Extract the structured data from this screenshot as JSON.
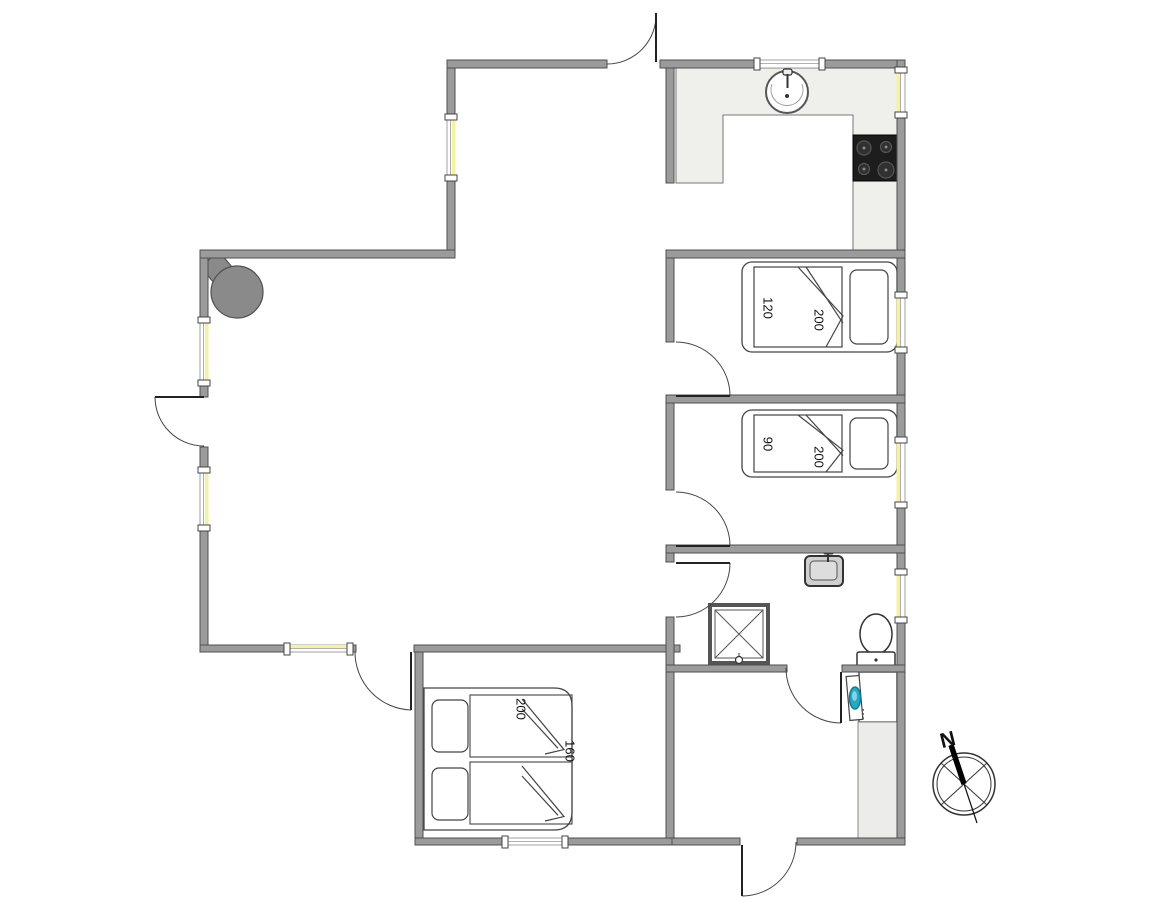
{
  "canvas": {
    "width": 1152,
    "height": 897,
    "background": "#ffffff"
  },
  "colors": {
    "wall": "#9b9b9b",
    "wall_stroke": "#4f4f4f",
    "window_glass": "#f5f2a0",
    "window_frame": "#8a8a8a",
    "counter": "#efefeb",
    "counter_stroke": "#777777",
    "cabinet": "#ececea",
    "stove_body": "#1d1d1d",
    "burner": "#303030",
    "burner_ring": "#555555",
    "fixture_stroke": "#3a3a3a",
    "door_arc": "#444444",
    "wood_stove": "#8a8a8a",
    "washer_glass": "#27a9c4",
    "washer_glass_dark": "#0e7d96",
    "washer_glass_light": "#7fd6e8",
    "sink_gray": "#cfcfcf"
  },
  "walls": [
    {
      "x": 447,
      "y": 60,
      "w": 160,
      "h": 8
    },
    {
      "x": 660,
      "y": 60,
      "w": 97,
      "h": 8
    },
    {
      "x": 822,
      "y": 60,
      "w": 83,
      "h": 8
    },
    {
      "x": 897,
      "y": 60,
      "w": 8,
      "h": 10
    },
    {
      "x": 897,
      "y": 115,
      "w": 8,
      "h": 180
    },
    {
      "x": 897,
      "y": 350,
      "w": 8,
      "h": 90
    },
    {
      "x": 897,
      "y": 505,
      "w": 8,
      "h": 67
    },
    {
      "x": 897,
      "y": 620,
      "w": 8,
      "h": 225
    },
    {
      "x": 447,
      "y": 68,
      "w": 8,
      "h": 49
    },
    {
      "x": 447,
      "y": 178,
      "w": 8,
      "h": 80
    },
    {
      "x": 200,
      "y": 250,
      "w": 255,
      "h": 8
    },
    {
      "x": 200,
      "y": 258,
      "w": 8,
      "h": 62
    },
    {
      "x": 200,
      "y": 383,
      "w": 8,
      "h": 14
    },
    {
      "x": 200,
      "y": 447,
      "w": 8,
      "h": 23
    },
    {
      "x": 200,
      "y": 528,
      "w": 8,
      "h": 124
    },
    {
      "x": 200,
      "y": 645,
      "w": 87,
      "h": 7
    },
    {
      "x": 350,
      "y": 645,
      "w": 6,
      "h": 7
    },
    {
      "x": 414,
      "y": 645,
      "w": 266,
      "h": 7
    },
    {
      "x": 415,
      "y": 652,
      "w": 8,
      "h": 193
    },
    {
      "x": 415,
      "y": 838,
      "w": 90,
      "h": 7
    },
    {
      "x": 565,
      "y": 838,
      "w": 107,
      "h": 7
    },
    {
      "x": 672,
      "y": 838,
      "w": 68,
      "h": 7
    },
    {
      "x": 797,
      "y": 838,
      "w": 108,
      "h": 7
    },
    {
      "x": 666,
      "y": 68,
      "w": 8,
      "h": 115
    },
    {
      "x": 666,
      "y": 250,
      "w": 239,
      "h": 8
    },
    {
      "x": 666,
      "y": 258,
      "w": 8,
      "h": 84
    },
    {
      "x": 666,
      "y": 395,
      "w": 239,
      "h": 8
    },
    {
      "x": 666,
      "y": 403,
      "w": 8,
      "h": 87
    },
    {
      "x": 666,
      "y": 545,
      "w": 239,
      "h": 8
    },
    {
      "x": 666,
      "y": 553,
      "w": 8,
      "h": 9
    },
    {
      "x": 666,
      "y": 617,
      "w": 8,
      "h": 221
    },
    {
      "x": 666,
      "y": 665,
      "w": 121,
      "h": 7
    },
    {
      "x": 842,
      "y": 665,
      "w": 63,
      "h": 7
    }
  ],
  "windows": [
    {
      "x": 447,
      "y": 117,
      "w": 8,
      "h": 61,
      "orient": "v",
      "glass": "right"
    },
    {
      "x": 200,
      "y": 320,
      "w": 8,
      "h": 63,
      "orient": "v",
      "glass": "right"
    },
    {
      "x": 200,
      "y": 470,
      "w": 8,
      "h": 58,
      "orient": "v",
      "glass": "right"
    },
    {
      "x": 757,
      "y": 60,
      "w": 65,
      "h": 8,
      "orient": "h",
      "glass": "none"
    },
    {
      "x": 897,
      "y": 70,
      "w": 8,
      "h": 45,
      "orient": "v",
      "glass": "left"
    },
    {
      "x": 897,
      "y": 295,
      "w": 8,
      "h": 55,
      "orient": "v",
      "glass": "left"
    },
    {
      "x": 897,
      "y": 440,
      "w": 8,
      "h": 65,
      "orient": "v",
      "glass": "left"
    },
    {
      "x": 897,
      "y": 572,
      "w": 8,
      "h": 48,
      "orient": "v",
      "glass": "left"
    },
    {
      "x": 287,
      "y": 645,
      "w": 63,
      "h": 7,
      "orient": "h",
      "glass": "top"
    },
    {
      "x": 505,
      "y": 838,
      "w": 60,
      "h": 7,
      "orient": "h",
      "glass": "none"
    }
  ],
  "doors": [
    {
      "name": "entrance-door-top",
      "leaf": [
        656,
        62,
        656,
        13
      ],
      "arc": "M 607 64 A 49 49 0 0 0 656 13"
    },
    {
      "name": "terrace-door-left",
      "leaf": [
        204,
        397,
        155,
        397
      ],
      "arc": "M 155 397 A 49 49 0 0 0 204 446"
    },
    {
      "name": "bedroom1-door",
      "leaf": [
        676,
        396,
        730,
        396
      ],
      "arc": "M 676 342 A 54 54 0 0 1 730 396"
    },
    {
      "name": "bedroom2-door",
      "leaf": [
        676,
        546,
        730,
        546
      ],
      "arc": "M 676 492 A 54 54 0 0 1 730 546"
    },
    {
      "name": "bathroom-door",
      "leaf": [
        676,
        563,
        730,
        563
      ],
      "arc": "M 730 563 A 54 54 0 0 1 676 617"
    },
    {
      "name": "utility-door",
      "leaf": [
        841,
        672,
        841,
        723
      ],
      "arc": "M 841 723 A 55 55 0 0 1 786 668"
    },
    {
      "name": "entrance-door-bottom",
      "leaf": [
        742,
        845,
        742,
        896
      ],
      "arc": "M 742 896 A 54 54 0 0 0 796 842"
    },
    {
      "name": "terrace-door-bottom-left",
      "leaf": [
        411,
        652,
        411,
        710
      ],
      "arc": "M 411 710 A 58 58 0 0 1 355 652"
    }
  ],
  "fixtures": [
    {
      "type": "counter-u",
      "name": "kitchen-counter",
      "path": "M676,68 H897 V250 H853 V115 H723 V183 H676 Z"
    },
    {
      "type": "sink-round",
      "name": "kitchen-sink",
      "cx": 787,
      "cy": 92,
      "r": 21
    },
    {
      "type": "stove",
      "name": "cooktop",
      "x": 853,
      "y": 135,
      "w": 44,
      "h": 46
    },
    {
      "type": "wood-stove",
      "name": "wood-stove",
      "cx": 237,
      "cy": 292,
      "r": 26,
      "flue": {
        "x": 206,
        "y": 256,
        "w": 24,
        "h": 26,
        "rot": -40
      }
    },
    {
      "type": "bed",
      "name": "bed-120x200",
      "x": 742,
      "y": 262,
      "w": 155,
      "h": 90,
      "head": "right"
    },
    {
      "type": "bed",
      "name": "bed-90x200",
      "x": 742,
      "y": 410,
      "w": 155,
      "h": 67,
      "head": "right"
    },
    {
      "type": "double-bed",
      "name": "double-bed-200x160",
      "x": 424,
      "y": 688,
      "w": 148,
      "h": 142
    },
    {
      "type": "shower",
      "name": "shower",
      "x": 710,
      "y": 605,
      "size": 58
    },
    {
      "type": "bath-sink",
      "name": "bathroom-sink",
      "x": 805,
      "y": 556,
      "w": 38,
      "h": 30
    },
    {
      "type": "toilet",
      "name": "toilet",
      "cx": 876,
      "cy": 634
    },
    {
      "type": "washer",
      "name": "washing-machine",
      "x": 859,
      "y": 672
    },
    {
      "type": "cabinet",
      "name": "utility-cabinet",
      "x": 858,
      "y": 722,
      "w": 39,
      "h": 120
    }
  ],
  "labels": [
    {
      "text": "120",
      "x": 767,
      "y": 308,
      "rot": 90,
      "size": 13
    },
    {
      "text": "200",
      "x": 818,
      "y": 320,
      "rot": 90,
      "size": 13
    },
    {
      "text": "90",
      "x": 767,
      "y": 444,
      "rot": 90,
      "size": 13
    },
    {
      "text": "200",
      "x": 818,
      "y": 457,
      "rot": 90,
      "size": 13
    },
    {
      "text": "200",
      "x": 520,
      "y": 709,
      "rot": 90,
      "size": 13
    },
    {
      "text": "160",
      "x": 569,
      "y": 751,
      "rot": 90,
      "size": 13
    }
  ],
  "compass": {
    "label": "N",
    "cx": 964,
    "cy": 784,
    "r_outer": 31,
    "r_inner": 27,
    "cross_lines": [
      [
        941,
        805,
        987,
        763
      ],
      [
        941,
        763,
        987,
        805
      ]
    ],
    "needle": [
      951,
      745,
      964,
      784
    ],
    "needle_tail": [
      964,
      784,
      977,
      823
    ],
    "label_x": 948,
    "label_y": 741,
    "label_rot": -14
  }
}
